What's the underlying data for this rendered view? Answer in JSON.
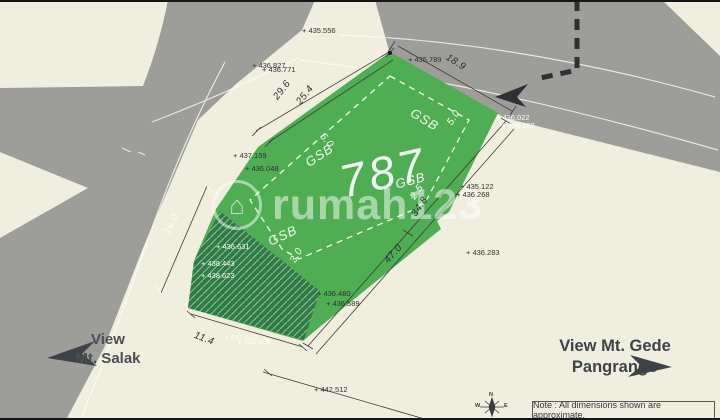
{
  "colors": {
    "background": "#f0efdf",
    "road": "#9d9d99",
    "plot_green": "#4fae53",
    "hatch_green": "#2e7b45",
    "dark_arrow": "#33383d",
    "text_dark": "#2e3134",
    "text_light": "#ffffff"
  },
  "watermark": {
    "brand": "rumah123",
    "icon": "house-in-circle"
  },
  "plot": {
    "area_label": "787"
  },
  "views": {
    "salak": {
      "line1": "View",
      "line2": "Mt. Salak"
    },
    "gede": {
      "line1": "View Mt. Gede",
      "line2": "Pangrango"
    }
  },
  "compass": {
    "north": "N",
    "west": "W",
    "east": "E"
  },
  "note": {
    "text": "Note : All dimensions shown are approximate."
  },
  "map_labels": [
    {
      "name": "elevation-435-556",
      "text": "+ 435.556",
      "x": 302,
      "y": 27,
      "rot": 0,
      "style": "elev-dark"
    },
    {
      "name": "elevation-436-827",
      "text": "+ 436.827",
      "x": 252,
      "y": 62,
      "rot": 0,
      "style": "elev-dark"
    },
    {
      "name": "elevation-436-771",
      "text": "+ 436.771",
      "x": 262,
      "y": 66,
      "rot": 0,
      "style": "elev-dark"
    },
    {
      "name": "elevation-435-789",
      "text": "+ 435.789",
      "x": 408,
      "y": 56,
      "rot": 0,
      "style": "elev-dark"
    },
    {
      "name": "elevation-437-159",
      "text": "+ 437.159",
      "x": 233,
      "y": 152,
      "rot": 0,
      "style": "elev-dark"
    },
    {
      "name": "elevation-436-048",
      "text": "+ 436.048",
      "x": 245,
      "y": 165,
      "rot": 0,
      "style": "elev-dark"
    },
    {
      "name": "elevation-435-122",
      "text": "+ 435.122",
      "x": 460,
      "y": 183,
      "rot": 0,
      "style": "elev-dark"
    },
    {
      "name": "elevation-436-268",
      "text": "+ 436.268",
      "x": 456,
      "y": 191,
      "rot": 0,
      "style": "elev-dark"
    },
    {
      "name": "elevation-436-283",
      "text": "+ 436.283",
      "x": 466,
      "y": 249,
      "rot": 0,
      "style": "elev-dark"
    },
    {
      "name": "elevation-436-480",
      "text": "+ 436.480",
      "x": 317,
      "y": 290,
      "rot": 0,
      "style": "elev-dark"
    },
    {
      "name": "elevation-436-589",
      "text": "+ 436.589",
      "x": 326,
      "y": 300,
      "rot": 0,
      "style": "elev-dark"
    },
    {
      "name": "elevation-442-512",
      "text": "+ 442.512",
      "x": 314,
      "y": 386,
      "rot": 0,
      "style": "elev-dark"
    },
    {
      "name": "elevation-436-022",
      "text": "+ 436.022",
      "x": 496,
      "y": 114,
      "rot": 0,
      "style": "elev-light"
    },
    {
      "name": "elevation-436-163",
      "text": "+ 436.163",
      "x": 501,
      "y": 122,
      "rot": 0,
      "style": "elev-light"
    },
    {
      "name": "elevation-436-631",
      "text": "+ 436.631",
      "x": 216,
      "y": 243,
      "rot": 0,
      "style": "elev-light"
    },
    {
      "name": "elevation-438-443",
      "text": "+ 438.443",
      "x": 201,
      "y": 260,
      "rot": 0,
      "style": "elev-light"
    },
    {
      "name": "elevation-438-623",
      "text": "+ 438.623",
      "x": 201,
      "y": 272,
      "rot": 0,
      "style": "elev-light"
    },
    {
      "name": "elevation-442-513",
      "text": "+ 442.513",
      "x": 224,
      "y": 334,
      "rot": 0,
      "style": "elev-light"
    },
    {
      "name": "elevation-433-600",
      "text": "+ 433.600",
      "x": 237,
      "y": 338,
      "rot": 0,
      "style": "elev-light"
    },
    {
      "name": "dimension-29-6",
      "text": "29.6",
      "x": 272,
      "y": 96,
      "rot": -52,
      "style": "dim-dark"
    },
    {
      "name": "dimension-25-4",
      "text": "25.4",
      "x": 295,
      "y": 101,
      "rot": -52,
      "style": "dim-dark"
    },
    {
      "name": "dimension-18-9",
      "text": "18.9",
      "x": 449,
      "y": 53,
      "rot": 32,
      "style": "dim-dark"
    },
    {
      "name": "dimension-34-8",
      "text": "34.8",
      "x": 410,
      "y": 213,
      "rot": -55,
      "style": "dim-dark"
    },
    {
      "name": "dimension-47-0",
      "text": "47.0",
      "x": 383,
      "y": 259,
      "rot": -48,
      "style": "dim-dark"
    },
    {
      "name": "dimension-11-4",
      "text": "11.4",
      "x": 196,
      "y": 331,
      "rot": 21,
      "style": "dim-dark"
    },
    {
      "name": "dimension-16-0",
      "text": "16.0",
      "x": 163,
      "y": 232,
      "rot": -66,
      "style": "dim-light"
    },
    {
      "name": "dimension-5-0-west",
      "text": "5.0",
      "x": 325,
      "y": 132,
      "rot": 50,
      "style": "dim-light"
    },
    {
      "name": "dimension-5-0-north",
      "text": "5.0",
      "x": 446,
      "y": 122,
      "rot": -58,
      "style": "dim-light"
    },
    {
      "name": "dimension-3-0",
      "text": "3.0",
      "x": 289,
      "y": 260,
      "rot": -60,
      "style": "dim-light"
    },
    {
      "name": "dimension-2-5",
      "text": "2.5",
      "x": 409,
      "y": 196,
      "rot": -55,
      "style": "dim-light"
    },
    {
      "name": "gsb-label-west",
      "text": "GSB",
      "x": 303,
      "y": 158,
      "rot": -33,
      "style": "gsb"
    },
    {
      "name": "gsb-label-north",
      "text": "GSB",
      "x": 415,
      "y": 106,
      "rot": 31,
      "style": "gsb"
    },
    {
      "name": "gsb-label-east",
      "text": "GSB",
      "x": 394,
      "y": 178,
      "rot": -15,
      "style": "gsb"
    },
    {
      "name": "gsb-label-south",
      "text": "GSB",
      "x": 266,
      "y": 236,
      "rot": -25,
      "style": "gsb"
    },
    {
      "name": "plot-area-label",
      "text": "787",
      "x": 335,
      "y": 160,
      "rot": -13,
      "style": "area"
    },
    {
      "name": "compass-letter-n",
      "text": "N",
      "x": 489,
      "y": 393,
      "rot": 0,
      "style": "compass-letter"
    },
    {
      "name": "compass-letter-w",
      "text": "W",
      "x": 475,
      "y": 404,
      "rot": 0,
      "style": "compass-letter"
    },
    {
      "name": "compass-letter-e",
      "text": "E",
      "x": 504,
      "y": 404,
      "rot": 0,
      "style": "compass-letter"
    }
  ]
}
